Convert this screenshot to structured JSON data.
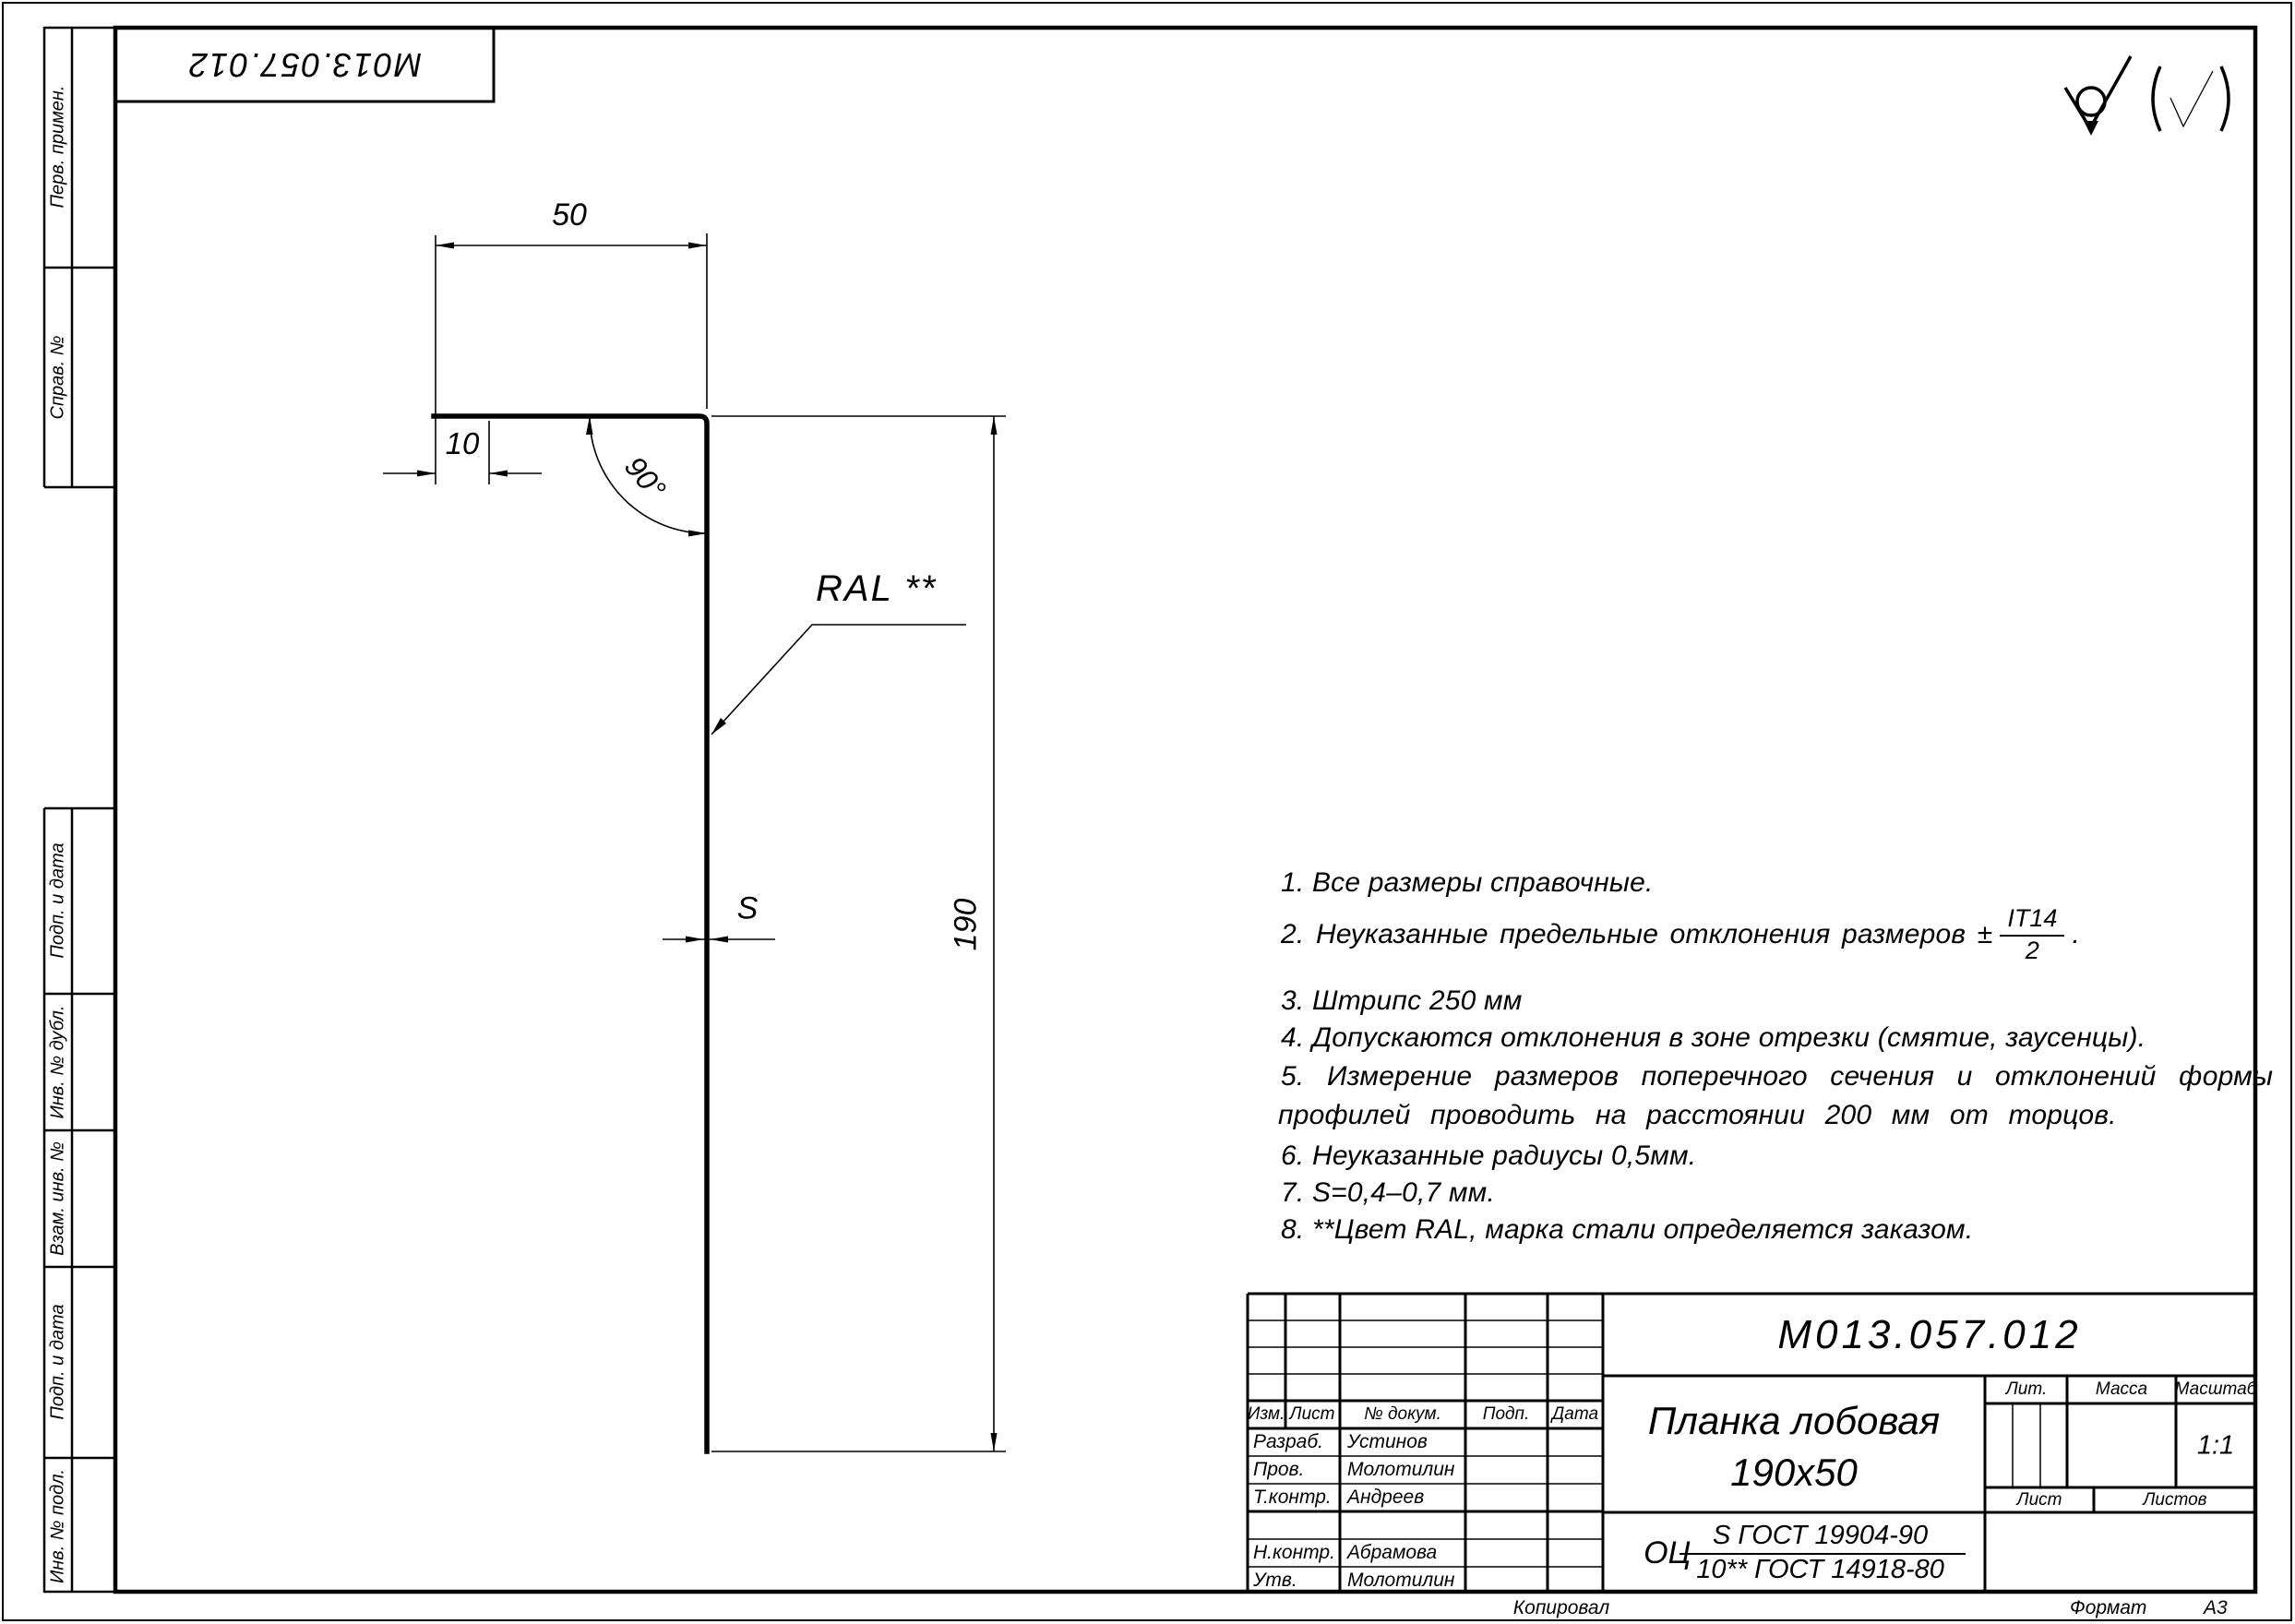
{
  "stamp": {
    "code": "М013.057.012"
  },
  "margin_strips": [
    "Перв. примен.",
    "Справ. №",
    "Подп. и дата",
    "Инв. № дубл.",
    "Взам. инв. №",
    "Подп. и дата",
    "Инв. № подл."
  ],
  "dimensions": {
    "width": "50",
    "flange": "10",
    "angle": "90°",
    "height": "190",
    "thickness": "S",
    "coating": "RAL **"
  },
  "icons": {
    "surface_finish": "check-with-circle-no-material-removal",
    "surface_finish_alt": "paren-checkmark"
  },
  "notes": {
    "n1": "1. Все размеры справочные.",
    "n2_prefix": "2. Неуказанные предельные отклонения размеров ±",
    "n2_frac_num": "IT14",
    "n2_frac_den": "2",
    "n2_suffix": ".",
    "n3": "3. Штрипс 250 мм",
    "n4": "4. Допускаются отклонения в зоне отрезки (смятие, заусенцы).",
    "n5a": "5. Измерение размеров поперечного сечения и отклонений формы",
    "n5b": "профилей проводить на расстоянии 200 мм от торцов.",
    "n6": "6. Неуказанные радиусы 0,5мм.",
    "n7": "7. S=0,4–0,7 мм.",
    "n8": "8. **Цвет RAL, марка стали определяется заказом."
  },
  "title_block": {
    "doc_number": "М013.057.012",
    "name_line1": "Планка лобовая",
    "name_line2": "190х50",
    "material_prefix": "ОЦ",
    "material_numerator": "S ГОСТ 19904-90",
    "material_denominator": "10** ГОСТ 14918-80",
    "col_izm": "Изм.",
    "col_list": "Лист",
    "col_doc": "№ докум.",
    "col_podp": "Подп.",
    "col_data": "Дата",
    "lit_label": "Лит.",
    "mass_label": "Масса",
    "scale_label": "Масштаб",
    "scale_value": "1:1",
    "sheet_label": "Лист",
    "sheets_label": "Листов",
    "roles": {
      "r1": "Разраб.",
      "r2": "Пров.",
      "r3": "Т.контр.",
      "r4": "Н.контр.",
      "r5": "Утв."
    },
    "names": {
      "n1": "Устинов",
      "n2": "Молотилин",
      "n3": "Андреев",
      "n4": "Абрамова",
      "n5": "Молотилин"
    }
  },
  "footer": {
    "copied": "Копировал",
    "format_label": "Формат",
    "format_value": "А3"
  }
}
